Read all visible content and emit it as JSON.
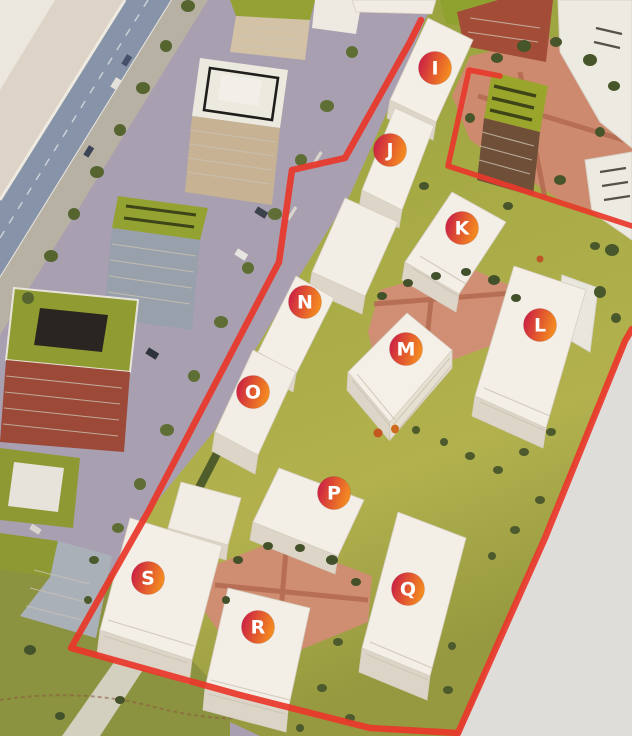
{
  "scene": {
    "photo_background": "#dfddd9",
    "boundary_color": "#e8382b",
    "badge_gradient_left": "#cb1f45",
    "badge_gradient_right": "#f6921e",
    "badge_text_color": "#ffffff"
  },
  "markers": [
    {
      "label": "I",
      "x": 435,
      "y": 68
    },
    {
      "label": "J",
      "x": 390,
      "y": 150
    },
    {
      "label": "K",
      "x": 462,
      "y": 228
    },
    {
      "label": "L",
      "x": 540,
      "y": 325
    },
    {
      "label": "M",
      "x": 406,
      "y": 349
    },
    {
      "label": "N",
      "x": 305,
      "y": 302
    },
    {
      "label": "O",
      "x": 253,
      "y": 392
    },
    {
      "label": "P",
      "x": 334,
      "y": 493
    },
    {
      "label": "Q",
      "x": 408,
      "y": 589
    },
    {
      "label": "R",
      "x": 258,
      "y": 627
    },
    {
      "label": "S",
      "x": 148,
      "y": 578
    }
  ],
  "boundary": {
    "main_path": "421,20 410,42 345,158 292,170 279,262 148,512 71,648 240,695 370,728 458,733 545,538 625,341 632,329",
    "notch_path": "500,76 469,70 448,166 632,226"
  }
}
